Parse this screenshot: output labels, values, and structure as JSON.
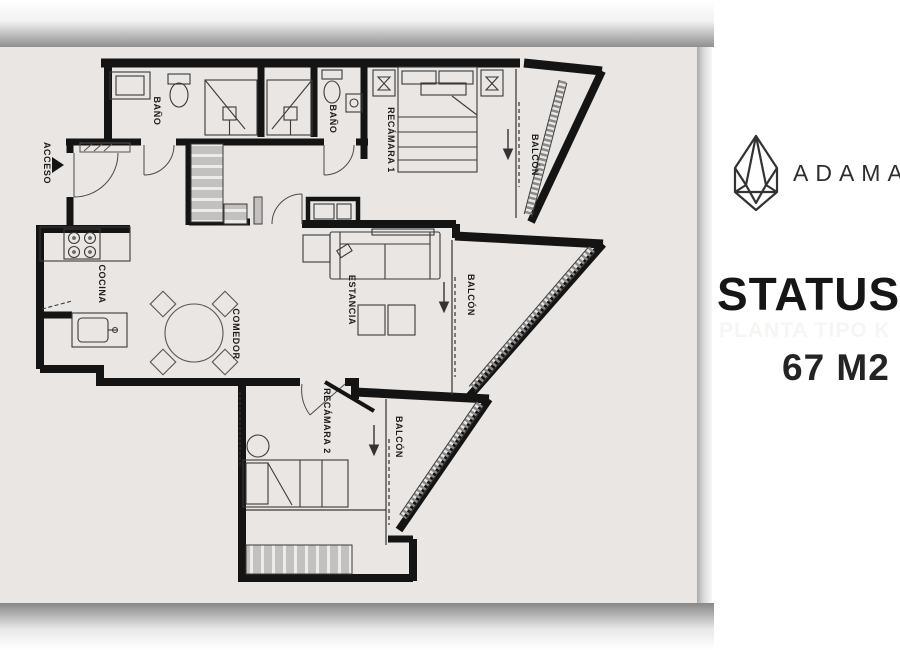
{
  "panel": {
    "brand": "ADAMA",
    "title": "STATUS",
    "subtitle": "PLANTA TIPO K",
    "area": "67 M2",
    "logo": "gem-diamond-logo"
  },
  "floorplan": {
    "labels": {
      "bath1": "BAÑO",
      "bath2": "BAÑO",
      "bedroom1": "RECÁMARA 1",
      "balcony1": "BALCÓN",
      "living": "ESTANCIA",
      "balcony2": "BALCÓN",
      "kitchen": "COCINA",
      "dining": "COMEDOR",
      "bedroom2": "RECÁMARA 2",
      "balcony3": "BALCÓN",
      "access": "ACCESO"
    }
  },
  "colors": {
    "card_background": "#EAE6E3",
    "walls": "#141414",
    "furniture_line": "#3a3a3a",
    "railing": "#7f7f7f",
    "closet_fill": "#c3c1bf",
    "panel_background": "#ffffff",
    "title_text": "#161616",
    "subtitle_text": "#f7f5f4"
  }
}
